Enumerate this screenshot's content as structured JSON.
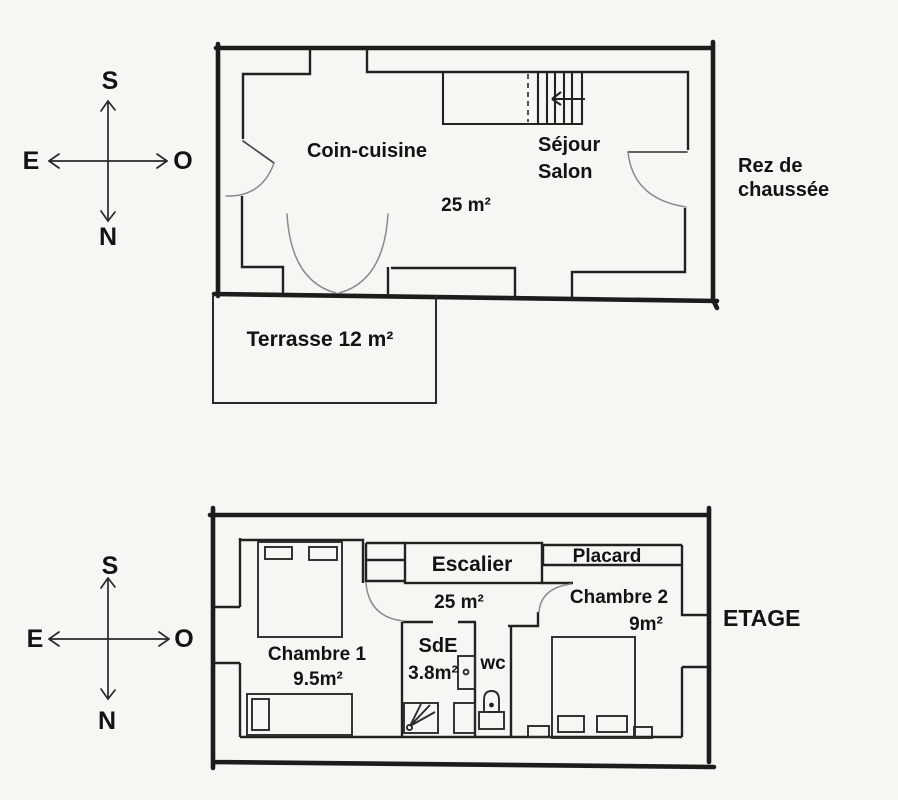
{
  "colors": {
    "paper": "#f6f6f3",
    "ink": "#1c1c1c",
    "door_arc_gray": "#8a8a8a"
  },
  "compass": {
    "top": "S",
    "left": "E",
    "right": "O",
    "bottom": "N"
  },
  "ground_floor": {
    "name_line1": "Rez de",
    "name_line2": "chaussée",
    "kitchen": "Coin-cuisine",
    "living_line1": "Séjour",
    "living_line2": "Salon",
    "area": "25 m²",
    "terrace": "Terrasse 12 m²"
  },
  "upper_floor": {
    "name": "ETAGE",
    "stairs": "Escalier",
    "area": "25 m²",
    "closet": "Placard",
    "bedroom1": "Chambre 1",
    "bedroom1_area": "9.5m²",
    "bedroom2": "Chambre 2",
    "bedroom2_area": "9m²",
    "shower_room": "SdE",
    "shower_room_area": "3.8m²",
    "wc": "wc"
  }
}
